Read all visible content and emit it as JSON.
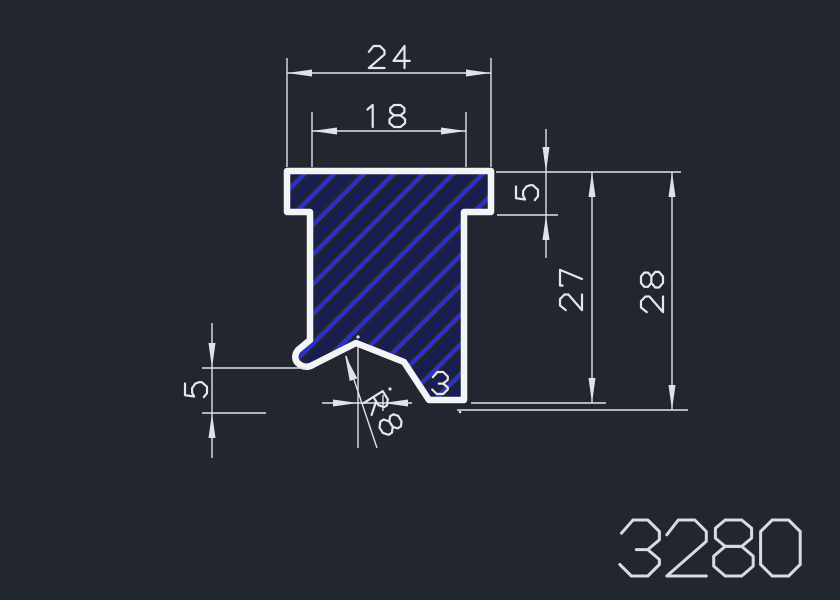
{
  "drawing": {
    "type": "cad-profile-section",
    "part_number": "3280",
    "dimensions": {
      "width_outer": "24",
      "width_inner": "18",
      "flange_thickness": "5",
      "depth_body": "27",
      "depth_overall": "28",
      "lip_height": "5",
      "foot_offset": "3",
      "notch_radius": "R8"
    },
    "colors": {
      "background": "#22262e",
      "outline": "#f2f4f6",
      "hatch": "#2c31c4",
      "hatch_shadow": "#1a1d52",
      "hatch_background": "#20242d",
      "dimension_lines": "#dfe3e6",
      "dimension_text": "#e4e7ea",
      "part_number_text": "#d8dce0"
    }
  }
}
